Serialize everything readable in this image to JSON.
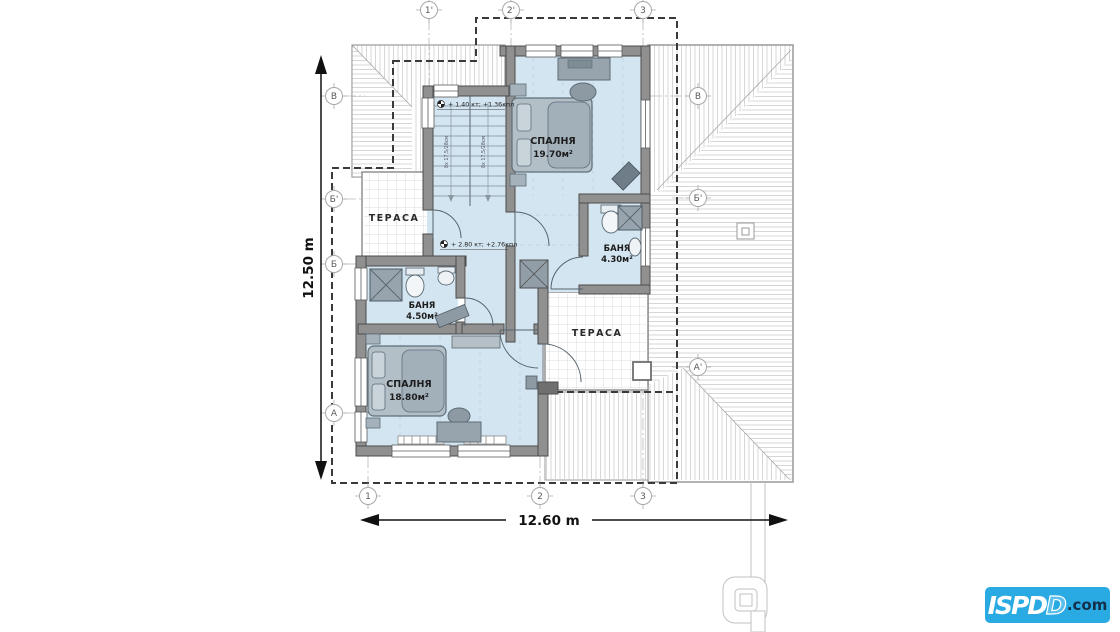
{
  "plan": {
    "grid_markers": {
      "top": [
        "1'",
        "2'",
        "3"
      ],
      "bottom": [
        "1",
        "2",
        "3"
      ],
      "left": [
        "В",
        "Б'",
        "Б",
        "А"
      ],
      "right": [
        "В",
        "Б'",
        "А'"
      ]
    },
    "dimensions": {
      "vertical": "12.50 m",
      "horizontal": "12.60 m"
    },
    "rooms": {
      "bedroom_north": {
        "name": "СПАЛНЯ",
        "area": "19.70м²"
      },
      "bath_east": {
        "name": "БАНЯ",
        "area": "4.30м²"
      },
      "terrace_west": {
        "name": "ТЕРАСА"
      },
      "bath_west": {
        "name": "БАНЯ",
        "area": "4.50м²"
      },
      "bedroom_south": {
        "name": "СПАЛНЯ",
        "area": "18.80м²"
      },
      "terrace_east": {
        "name": "ТЕРАСА"
      }
    },
    "level_annotations": {
      "upper": "+ 1.40 кт; +1.36кпл",
      "lower": "+ 2.80 кт; +2.76кпл"
    },
    "stair_note": "8х 17,5/28см"
  },
  "logo": {
    "main": "ISPD",
    "outline_letter": "D",
    "suffix": ".com"
  },
  "colors": {
    "room_fill": "#d3e5f0",
    "wall_fill": "#909090",
    "roof_hatch": "#c9cdd1",
    "logo_bg": "#29aae3",
    "logo_suffix_color": "#14304a"
  }
}
